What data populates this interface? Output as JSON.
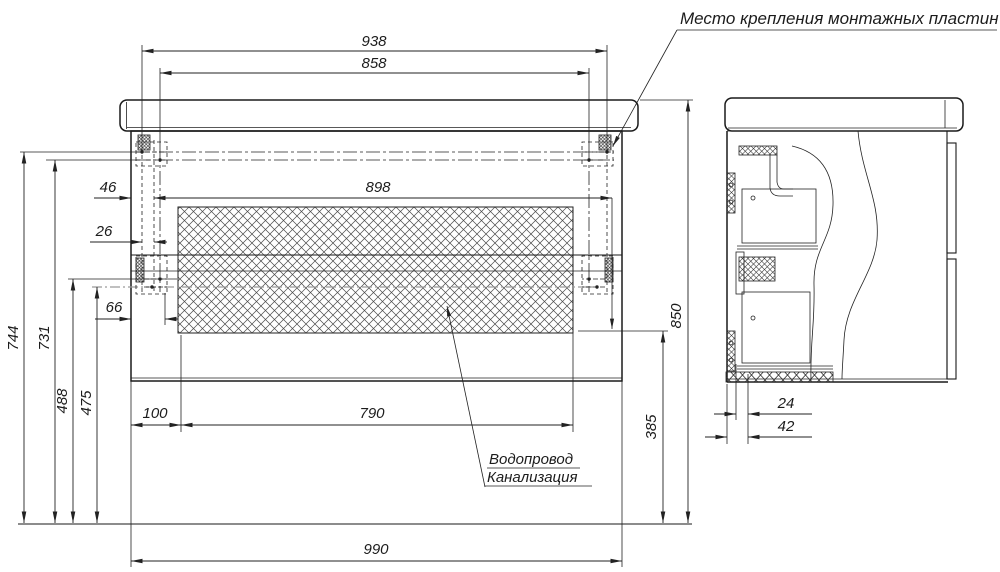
{
  "callouts": {
    "mounting_plates": "Место крепления монтажных пластин",
    "water": "Водопровод",
    "sewer": "Канализация"
  },
  "dimensions": {
    "front": {
      "w938": "938",
      "w858": "858",
      "w898": "898",
      "o46": "46",
      "o26": "26",
      "o66": "66",
      "o100": "100",
      "o790": "790",
      "w990": "990",
      "h744": "744",
      "h731": "731",
      "h488": "488",
      "h475": "475",
      "h385": "385",
      "h850": "850"
    },
    "side": {
      "o24": "24",
      "o42": "42"
    }
  }
}
